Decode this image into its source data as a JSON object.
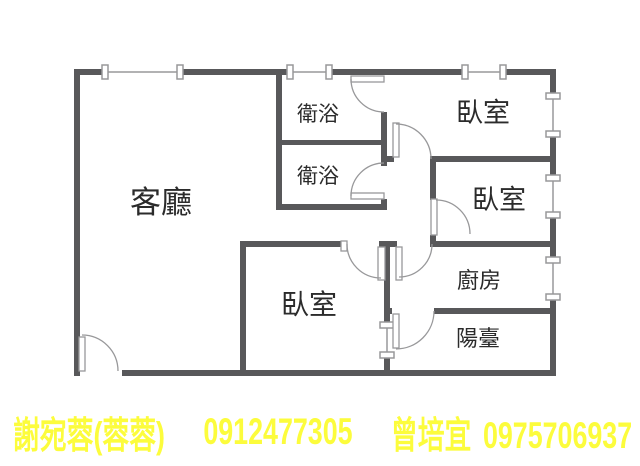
{
  "floorplan": {
    "title": "apartment-floor-plan",
    "rooms": [
      {
        "id": "living-room",
        "label": "客廳"
      },
      {
        "id": "bathroom-1",
        "label": "衛浴"
      },
      {
        "id": "bathroom-2",
        "label": "衛浴"
      },
      {
        "id": "bedroom-1",
        "label": "臥室"
      },
      {
        "id": "bedroom-2",
        "label": "臥室"
      },
      {
        "id": "bedroom-3",
        "label": "臥室"
      },
      {
        "id": "kitchen",
        "label": "廚房"
      },
      {
        "id": "balcony",
        "label": "陽臺"
      }
    ],
    "colors": {
      "wall": "#58585a",
      "fixture_line": "#98989a",
      "label_text": "#2b2b2b",
      "background": "#ffffff"
    },
    "counts": {
      "bedrooms": 3,
      "bathrooms": 2,
      "balconies": 1,
      "kitchens": 1
    }
  },
  "contact_bar": {
    "agent1_name": "謝宛蓉(蓉蓉)",
    "agent1_phone": "0912477305",
    "agent2_name": "曾培宜",
    "agent2_phone": "0975706937",
    "text_color": "#fcfc3c"
  }
}
